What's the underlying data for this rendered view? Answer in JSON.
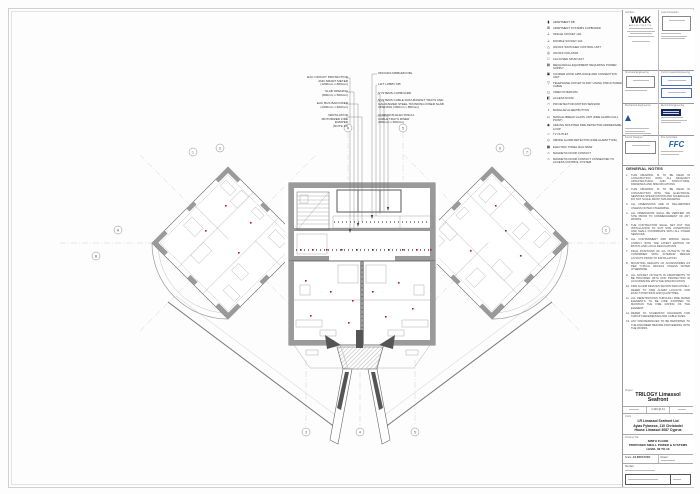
{
  "annotations": {
    "left": [
      {
        "text": "EAC CIRCUIT PROTECTION\nAND SMART METER\n(1200mm x 800mm)"
      },
      {
        "text": "SLAB OPENING\n(800mm x 500mm)"
      },
      {
        "text": "EAC BUS BAR RISER\n(1000mm x 600mm)"
      },
      {
        "text": "VENTILATION\nMOTORIZED FIRE\nDAMPER\n(NOTE 10)"
      }
    ],
    "right": [
      {
        "text": "OFFICES MDBs/MCCBs"
      },
      {
        "text": "LIFT LOBBY DB"
      },
      {
        "text": "SYSTEMS CUPBOARD"
      },
      {
        "text": "SYSTEMS CABLE DATA BASKET TRAYS AND\nGALVANIZED STEEL TRUNKING RISER SLAB\nOPENING (300mm x 800mm)"
      },
      {
        "text": "COMMONS ELECTRICAL\nCABLE TRAYS RISER\n(800mm x 600mm)"
      }
    ]
  },
  "legend": {
    "items": [
      {
        "g": "▮",
        "label": "APARTMENT DB"
      },
      {
        "g": "⊞",
        "label": "APARTMENT SYSTEMS CUPBOARD"
      },
      {
        "g": "⊥",
        "label": "SINGLE SOCKET 13A"
      },
      {
        "g": "⊥",
        "label": "DOUBLE SOCKET 13A"
      },
      {
        "g": "△",
        "label": "ON/OFF SWITCHED CONTROL UNIT"
      },
      {
        "g": "◎",
        "label": "ON/OFF ISOLATOR"
      },
      {
        "g": "□",
        "label": "13A FUSED SPUR UNIT"
      },
      {
        "g": "▤",
        "label": "MECHANICAL EQUIPMENT REQUIRING POWER SUPPLY"
      },
      {
        "g": "▣",
        "label": "COOKER HOOD APPLIANCE AND CONNECTION UNIT"
      },
      {
        "g": "▽",
        "label": "TELEPHONE OUTLET IN DRY LINING STRUCTURED CABLE"
      },
      {
        "g": "◻",
        "label": "VIDEO INTERCOM"
      },
      {
        "g": "◧",
        "label": "ACCESS DOOR"
      },
      {
        "g": "∩",
        "label": "PIR DETECTOR (MOTION SENSOR)"
      },
      {
        "g": "▪",
        "label": "BURGLAR ALARM BUTTON"
      },
      {
        "g": "▭",
        "label": "MANUAL BREAK GLASS UNIT (FIRE ALARM CALL POINT)"
      },
      {
        "g": "◉",
        "label": "CEILING MOUNTED FIRE DETECTOR ADDRESSABLE LOOP"
      },
      {
        "g": "○",
        "label": "TV OUTLET"
      },
      {
        "g": "◇",
        "label": "SMOKE ALARM DETECTOR (FIRE ALARM TYPE)"
      },
      {
        "g": "▦",
        "label": "ELECTRIC TOWEL RAIL 500W"
      },
      {
        "g": "⌂",
        "label": "MAGNETIC DOOR CONTACT"
      },
      {
        "g": "⌂",
        "label": "MAGNETIC DOOR CONTACT CONNECTED TO ACCESS CONTROL SYSTEM"
      }
    ]
  },
  "plan": {
    "bubbles": [
      "1",
      "2",
      "4",
      "5",
      "6",
      "7",
      "A",
      "B",
      "C",
      "D",
      "3",
      "4",
      "5"
    ]
  },
  "general_notes": {
    "title": "GENERAL NOTES",
    "items": [
      "THIS DRAWING IS TO BE READ IN CONJUNCTION WITH ALL RELEVANT ARCHITECTURAL AND STRUCTURAL DRAWINGS AND SPECIFICATIONS.",
      "THIS DRAWING IS TO BE READ IN CONJUNCTION WITH THE ELECTRICAL SERVICES SPECIFICATION AND SCHEDULES. DO NOT SCALE FROM THIS DRAWING.",
      "ALL DIMENSIONS ARE IN MILLIMETRES UNLESS NOTED OTHERWISE.",
      "ALL DIMENSIONS SHALL BE VERIFIED ON SITE PRIOR TO COMMENCEMENT OF ANY WORKS.",
      "THE CONTRACTOR SHALL SET OUT THE INSTALLATION TO SUIT SITE CONDITIONS AND SHALL COORDINATE WITH ALL OTHER SERVICES.",
      "ALL CONTAINMENT AND WIRING SHALL COMPLY WITH THE LATEST EDITION OF BS7671 AND LOCAL REGULATIONS.",
      "FINAL POSITIONS OF ALL OUTLETS TO BE CONFIRMED WITH INTERIOR DESIGN LAYOUTS PRIOR TO INSTALLATION.",
      "MOUNTING HEIGHTS OF ACCESSORIES AS PER TYPICAL DETAILS UNLESS NOTED OTHERWISE.",
      "ALL SOCKET OUTLETS IN APARTMENTS TO BE PROVIDED WITH RCD PROTECTION IN ACCORDANCE WITH THE SPECIFICATION.",
      "FIRE ALARM DEVICES SHOWN INDICATIVELY. REFER TO FIRE ALARM LAYOUTS FOR EXACT POSITIONS AND QUANTITIES.",
      "ALL PENETRATIONS THROUGH FIRE RATED ELEMENTS TO BE FIRE STOPPED TO MAINTAIN THE FIRE RATING OF THE ELEMENT.",
      "REFER TO SCHEMATIC DIAGRAMS FOR CIRCUIT REFERENCES AND CABLE SIZES.",
      "ANY DISCREPANCIES TO BE REPORTED TO THE ENGINEER BEFORE PROCEEDING WITH THE WORKS."
    ]
  },
  "titleblock": {
    "sections": {
      "architect": "Architect",
      "lead": "Lead Consultant",
      "structural": "Structural Engineering",
      "civil": "Civil & Coastal Engineering",
      "mechanical": "Mechanical Engineering",
      "electrical": "Electrical Engineering",
      "interior": "Interior Designer",
      "fire": "Fire Consultant"
    },
    "wkk_logo": "WKK",
    "wkk_sub": "ARCHITECTS",
    "ffc_logo": "FFC",
    "project_label": "Project",
    "project_title": "TRILOGY Limassol Seafront",
    "scale_chip": "1:100 @ A1",
    "client_label": "Client",
    "client_lines": "LR Limassol Seafront Ltd\nAyias Fylaxeos, 110 Christodel\nHouse Limassol 3087 Cyprus",
    "drawing_title_label": "Drawing Title",
    "drawing_title_lines": "NINTH FLOOR\nPROPOSED SMALL POWER & SYSTEMS\nLEVEL 09 TO 13",
    "scale_label": "Scale:",
    "scale_value": "AS INDICATED",
    "drawn_label": "Drawn:",
    "number_label": "Number"
  }
}
